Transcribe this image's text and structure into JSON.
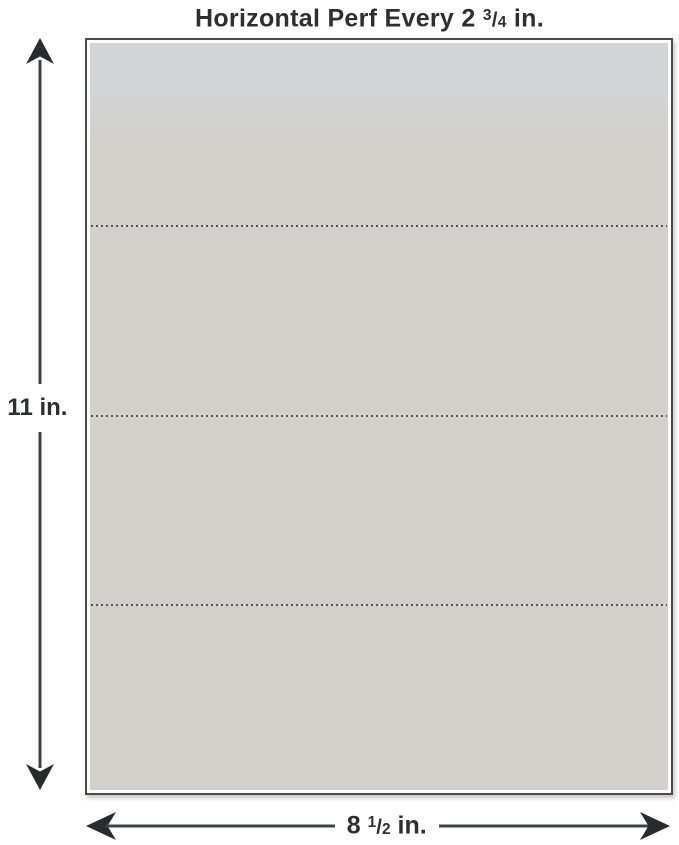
{
  "title": {
    "prefix": "Horizontal Perf Every 2 ",
    "frac_num": "3",
    "frac_slash": "/",
    "frac_den": "4",
    "suffix": " in."
  },
  "labels": {
    "height": "11 in.",
    "width_prefix": "8 ",
    "width_frac_num": "1",
    "width_frac_slash": "/",
    "width_frac_den": "2",
    "width_suffix": " in."
  },
  "perforations": {
    "count": 3,
    "positions_pct": [
      24.6,
      49.8,
      74.9
    ]
  },
  "colors": {
    "background": "#ffffff",
    "text": "#2e2f31",
    "paper-fill": "#d1d0ca",
    "paper-fill-top": "#d3d4d6",
    "paper-border": "#4b4b4d",
    "paper-inner-border": "#fcfcfa",
    "perf-dot": "#55555a",
    "arrow": "#3f4043",
    "arrow-head": "#2a2b2d"
  }
}
